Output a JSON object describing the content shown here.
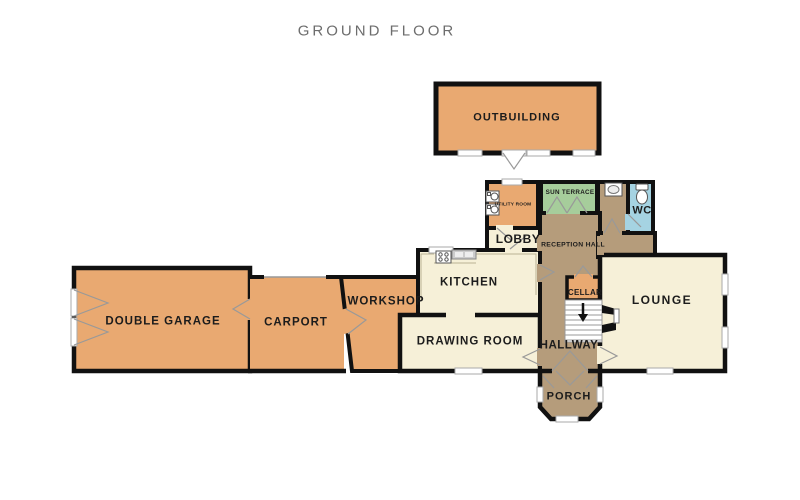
{
  "title": "GROUND FLOOR",
  "colors": {
    "room_orange": "#E9A971",
    "room_cream": "#F6F0D8",
    "room_tan": "#B59C7B",
    "room_green": "#A6CD9B",
    "room_blue": "#A5D3E2",
    "wall": "#111111",
    "swing_line": "#999999",
    "stair_white": "#FFFFFF",
    "title_gray": "#6D6D6D",
    "label_black": "#1C1C1C"
  },
  "rooms": {
    "outbuilding": {
      "label": "OUTBUILDING"
    },
    "double_garage": {
      "label": "DOUBLE GARAGE"
    },
    "carport": {
      "label": "CARPORT"
    },
    "workshop": {
      "label": "WORKSHOP"
    },
    "kitchen": {
      "label": "KITCHEN"
    },
    "drawing_room": {
      "label": "DRAWING ROOM"
    },
    "lobby": {
      "label": "LOBBY"
    },
    "utility_room": {
      "label": "UTILITY ROOM"
    },
    "sun_terrace": {
      "label": "SUN TERRACE"
    },
    "reception_hall": {
      "label": "RECEPTION HALL"
    },
    "wc": {
      "label": "WC"
    },
    "cellar": {
      "label": "CELLAR"
    },
    "lounge": {
      "label": "LOUNGE"
    },
    "hallway": {
      "label": "HALLWAY"
    },
    "porch": {
      "label": "PORCH"
    }
  },
  "icons": {
    "washing-machine-icon": "square-with-drum",
    "stove-icon": "four-burner-hob",
    "kitchen-sink-icon": "double-basin",
    "hand-basin-icon": "oval-basin",
    "toilet-icon": "bowl-and-cistern",
    "staircase-icon": "treads",
    "stairs-down-arrow-icon": "down-arrow",
    "fireplace-icon": "hearth-wedges"
  }
}
